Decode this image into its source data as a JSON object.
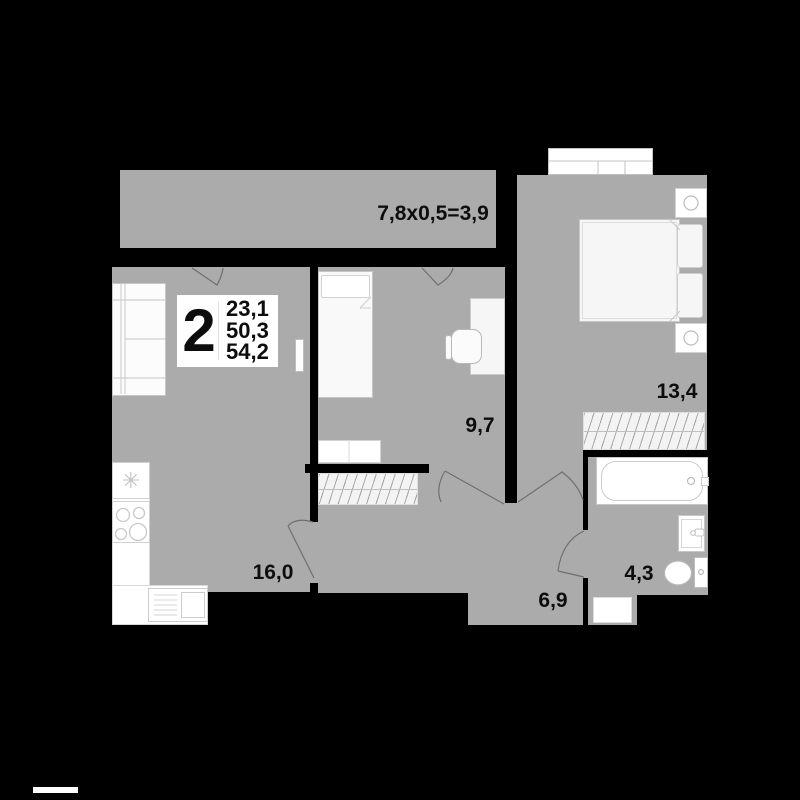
{
  "info_box": {
    "room_count": "2",
    "living_area": "23,1",
    "area_without_balcony": "50,3",
    "total_area": "54,2"
  },
  "balcony": {
    "dimension_label": "7,8x0,5=3,9"
  },
  "room_areas": {
    "kitchen_living": "16,0",
    "bedroom": "13,4",
    "second_room": "9,7",
    "hallway": "6,9",
    "bathroom": "4,3"
  },
  "symbols": {
    "fridge_star": "✳"
  },
  "colors": {
    "background": "#000000",
    "floor_gray": "#ababab",
    "furniture_white": "#ffffff",
    "label_black": "#0d0d0d"
  }
}
